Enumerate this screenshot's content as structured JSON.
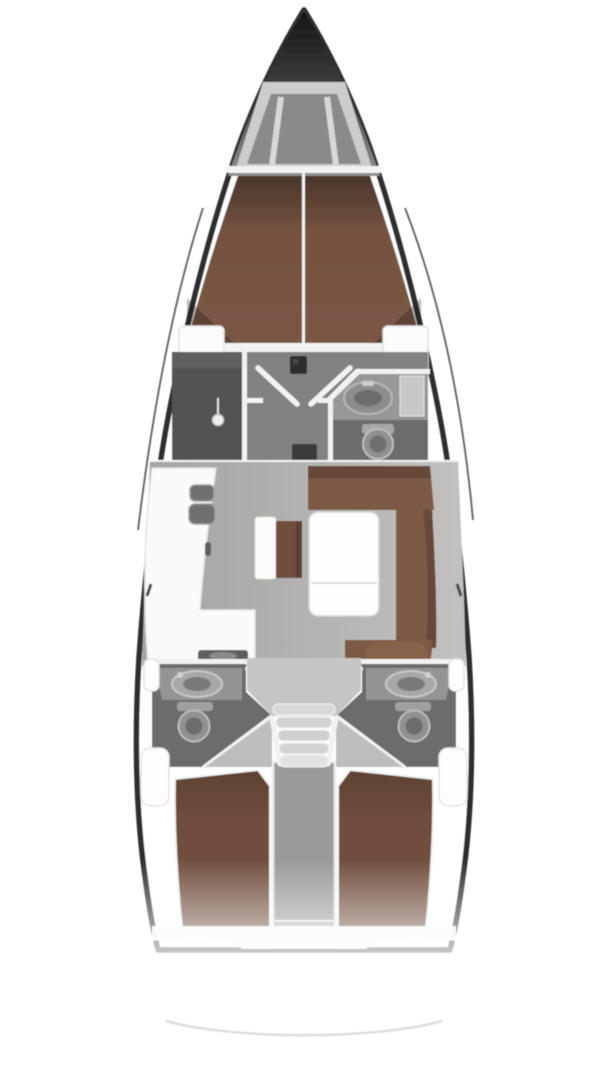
{
  "diagram": {
    "type": "boat-floor-plan",
    "subject": "sailing-yacht-interior-layout-top-view",
    "orientation": "bow-up",
    "regions": [
      "bow",
      "anchor-locker",
      "forward-cabin",
      "forward-berth",
      "shower-room",
      "forward-head",
      "salon",
      "galley",
      "dinette",
      "settee",
      "saloon-table",
      "companionway-steps",
      "aft-head-port",
      "aft-head-starboard",
      "aft-cabin-port",
      "aft-cabin-starboard",
      "engine-compartment",
      "transom",
      "stern"
    ],
    "fixtures": {
      "toilets": 3,
      "washbasins": 3,
      "galley_sink_basins": 2,
      "berths": 3,
      "tables": 1,
      "companionway_steps": 5
    }
  },
  "colors": {
    "background": "#ffffff",
    "hull-line": "#2e2e2e",
    "rigging": "#424242",
    "bow-dark": "#161616",
    "locker-light": "#cccccc",
    "locker-dark": "#8a8a8a",
    "deck-white": "#f4f4f4",
    "berth-brown": "#7b5846",
    "berth-shadow": "#4a372c",
    "settee-brown": "#7d5a45",
    "settee-back": "#66493a",
    "cushion-light": "#87624c",
    "aft-berth": "#6f4e3d",
    "salon-floor": "#b3b2b0",
    "cabin-floor": "#828282",
    "head-floor": "#6c6c6c",
    "shower-floor": "#525252",
    "counter-white": "#fafafa",
    "counter-gray": "#949494",
    "fixture-light": "#a8a8a8",
    "fixture-mid": "#909090",
    "fixture-dark": "#6c6c6c",
    "sink-basin": "#6f6f6f",
    "wall-white": "#f2f2f2",
    "step-gray": "#d4d4d4",
    "engine-gray": "#a0a0a0",
    "wedge-gray": "#bdbdbd",
    "floor-light": "#c6c5c3",
    "table-white": "#fdfdfd",
    "shelf-white": "#fbfbfb",
    "stern-arc": "#d9d9d9",
    "mast-dark": "#2d2d2d"
  }
}
